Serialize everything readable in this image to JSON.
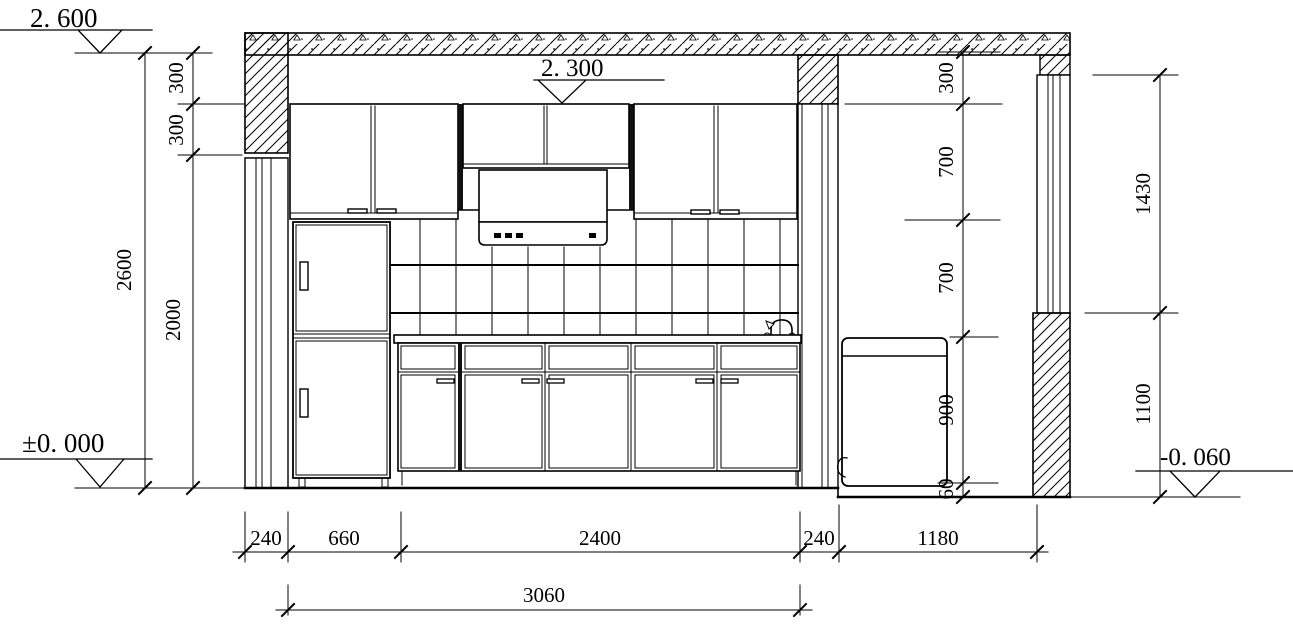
{
  "colors": {
    "line": "#000000",
    "background": "#ffffff"
  },
  "levels": {
    "ceiling": "2. 600",
    "soffit": "2. 300",
    "floor": "±0. 000",
    "right_floor": "-0. 060"
  },
  "dims": {
    "left_total": "2600",
    "left_top_300": "300",
    "left_mid_300": "300",
    "left_2000": "2000",
    "right_300": "300",
    "right_700_upper": "700",
    "right_700_lower": "700",
    "right_900": "900",
    "right_60": "60",
    "far_right_1430": "1430",
    "far_right_1100": "1100",
    "bottom_240_left": "240",
    "bottom_660": "660",
    "bottom_2400": "2400",
    "bottom_240_right": "240",
    "bottom_1180": "1180",
    "bottom_total_3060": "3060"
  },
  "icons": {
    "faucet": "faucet-icon",
    "drain_hose": "drain-hose-icon",
    "level_marker": "level-triangle-icon"
  }
}
